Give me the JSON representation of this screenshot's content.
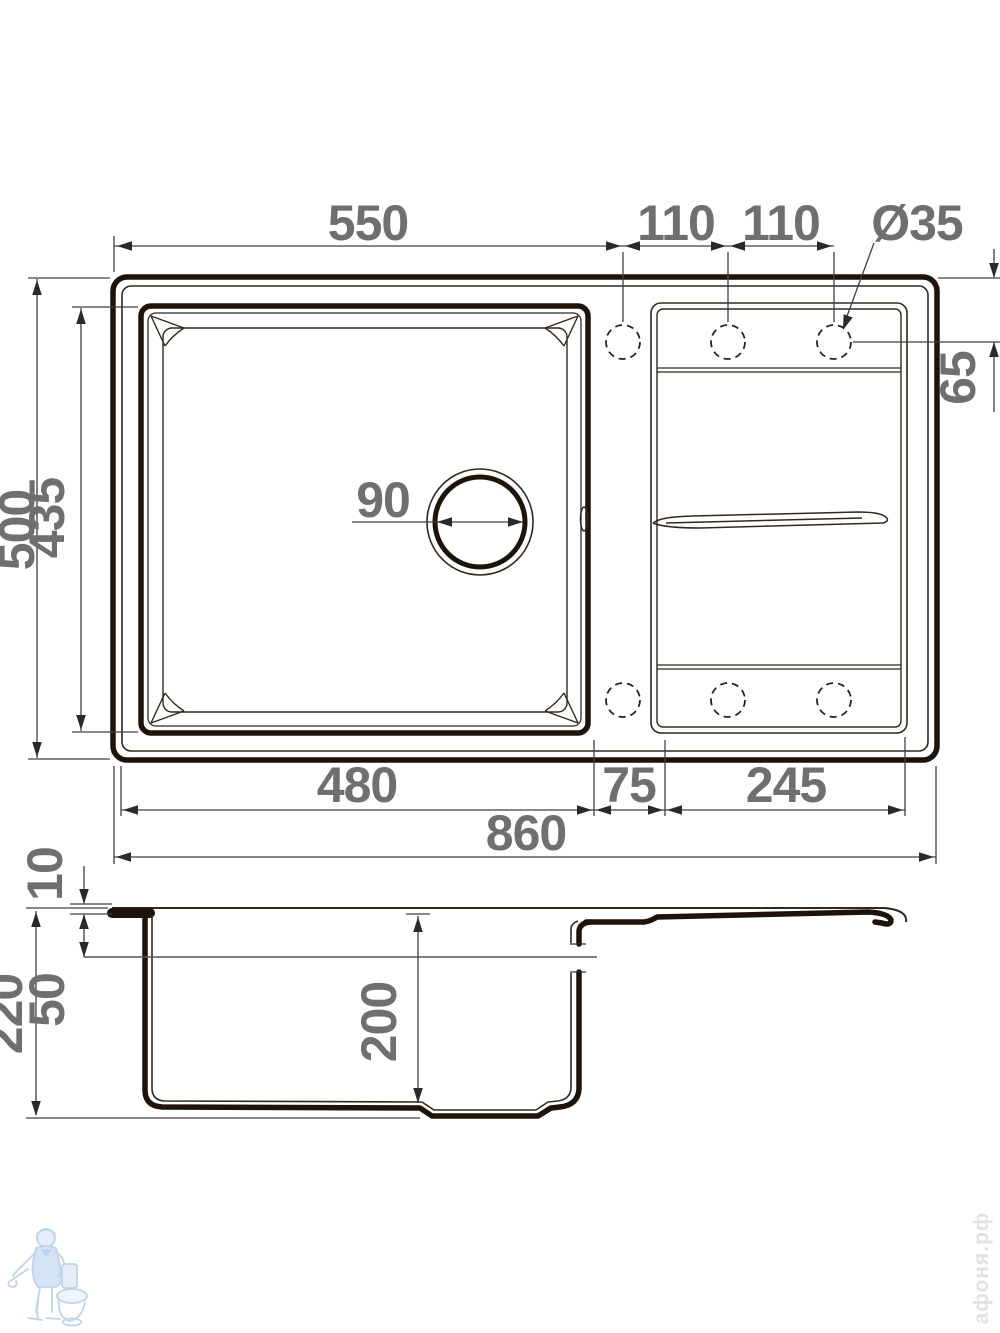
{
  "meta": {
    "description": "Kitchen sink installation drawing: top view with bowl, drainboard and faucet holes, plus side section view"
  },
  "colors": {
    "thick_line": "#1e1308",
    "thin_line": "#32281e",
    "dim_line": "#404040",
    "dim_text": "#6f6f6f",
    "logo_blue": "#bcd2ec",
    "brand_gray": "#e2e2e2"
  },
  "top_view": {
    "width_550": "550",
    "hole_spacing_a": "110",
    "hole_spacing_b": "110",
    "hole_diameter": "Ø35",
    "hole_offset_65": "65",
    "overall_depth_500": "500",
    "bowl_depth_435": "435",
    "drain_diameter_90": "90",
    "bowl_width_480": "480",
    "mid_width_75": "75",
    "board_width_245": "245",
    "overall_width_860": "860"
  },
  "side_view": {
    "rim_height_10": "10",
    "overflow_depth_50": "50",
    "overall_height_220": "220",
    "bowl_inner_depth_200": "200"
  },
  "watermarks": {
    "brand": "афоня.рф"
  }
}
